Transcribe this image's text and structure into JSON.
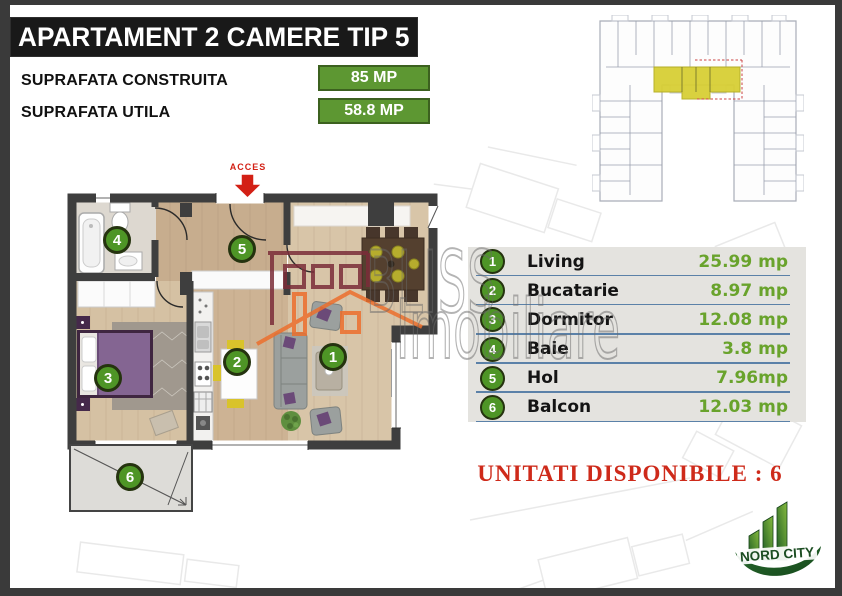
{
  "title": "APARTAMENT 2 CAMERE TIP 5",
  "specs": {
    "construita_label": "SUPRAFATA CONSTRUITA",
    "construita_value": "85 MP",
    "utila_label": "SUPRAFATA UTILA",
    "utila_value": "58.8 MP"
  },
  "floor_plan": {
    "access_label": "ACCES"
  },
  "rooms": [
    {
      "num": "1",
      "name": "Living",
      "area": "25.99 mp"
    },
    {
      "num": "2",
      "name": "Bucatarie",
      "area": "8.97 mp"
    },
    {
      "num": "3",
      "name": "Dormitor",
      "area": "12.08 mp"
    },
    {
      "num": "4",
      "name": "Baie",
      "area": "3.8 mp"
    },
    {
      "num": "5",
      "name": "Hol",
      "area": "7.96mp"
    },
    {
      "num": "6",
      "name": "Balcon",
      "area": "12.03 mp"
    }
  ],
  "availability": "UNITATI DISPONIBILE  : 6",
  "watermark": {
    "line1": "BLISS",
    "line2": "Imobiliare"
  },
  "logo_text": "NORD CITY",
  "colors": {
    "badge_green": "#5d9732",
    "marker_green": "#4e9526",
    "accent_red": "#ce2a1a",
    "highlight_yellow": "#d8cf35",
    "wall_dark": "#3e3e3e"
  }
}
